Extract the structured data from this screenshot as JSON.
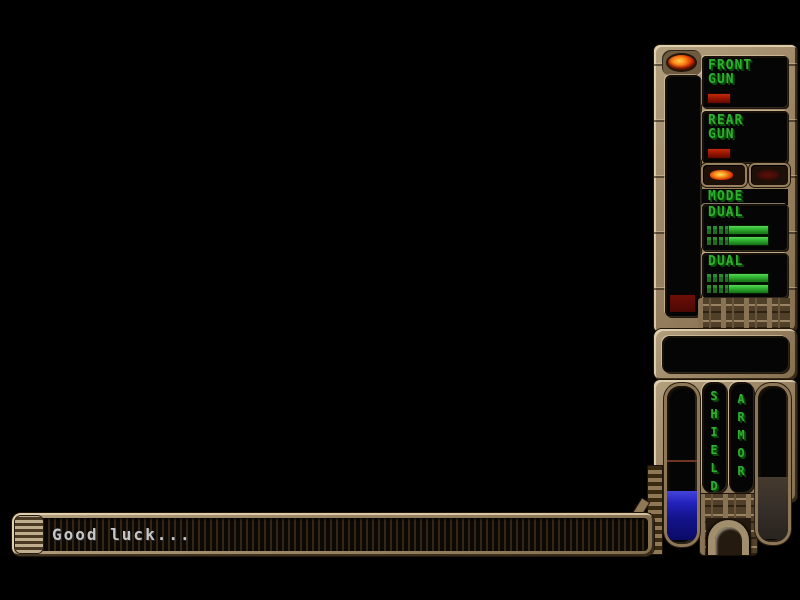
{
  "window": {
    "width": 800,
    "height": 600
  },
  "hud": {
    "front_gun": {
      "label": "FRONT\nGUN",
      "power_pct": "26%"
    },
    "rear_gun": {
      "label": "REAR\nGUN",
      "power_pct": "26%"
    },
    "mode": {
      "label": "MODE",
      "left_light": "on",
      "right_light": "off"
    },
    "weapon_modes": [
      {
        "label": "DUAL",
        "rows": 2,
        "fill_pct": "50%"
      },
      {
        "label": "DUAL",
        "rows": 2,
        "fill_pct": "50%"
      }
    ],
    "shield": {
      "label": "SHIELD",
      "fill_pct": "31%",
      "marker_from_top_pct": "47%"
    },
    "armor": {
      "label": "ARMOR",
      "fill_pct": "40%"
    }
  },
  "message_bar": {
    "text": "Good luck..."
  },
  "colors": {
    "hud_metal": "#9c8565",
    "display_green": "#2fae2f",
    "power_red": "#8e1200",
    "shield_blue": "#2222bb",
    "armor_fill": "#3a3026",
    "led_orange": "#ff8a1a",
    "message_text": "#c6c6c6"
  }
}
